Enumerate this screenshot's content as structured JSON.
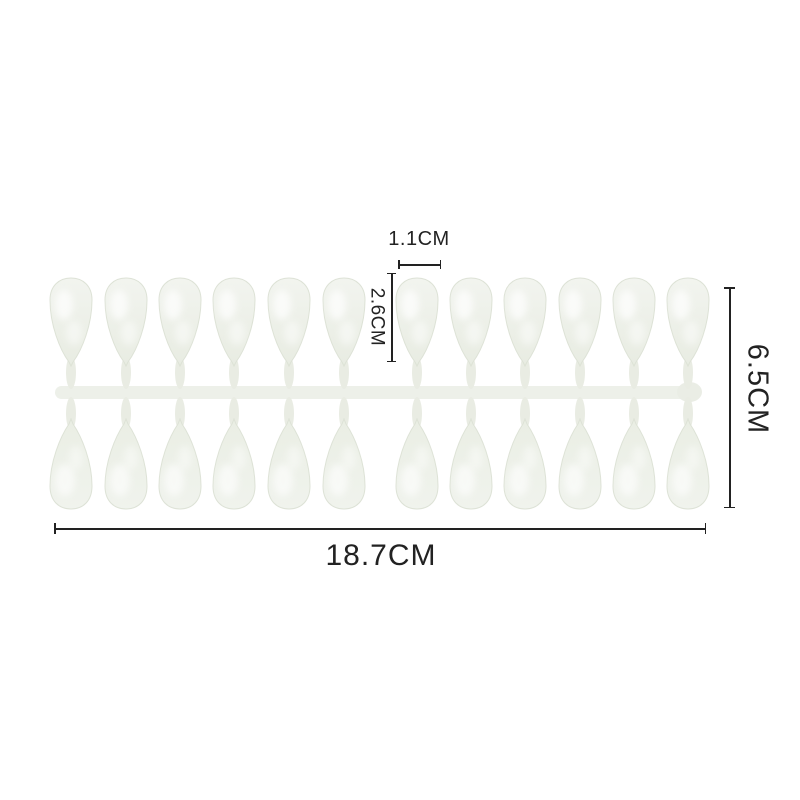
{
  "page": {
    "background": "#ffffff",
    "description": "False nail tips on molding sprue with size annotations"
  },
  "product": {
    "name": "nail-tips-sprue",
    "rows": 2,
    "tips_per_row": 12,
    "tip_fill_light": "#f2f4ef",
    "tip_fill_dark": "#e8ece2",
    "sprue_color": "#edf0e9"
  },
  "annotations": {
    "tip_width": "1.1CM",
    "tip_length": "2.6CM",
    "sheet_height": "6.5CM",
    "sheet_width": "18.7CM"
  },
  "annotation_color": "#222222"
}
